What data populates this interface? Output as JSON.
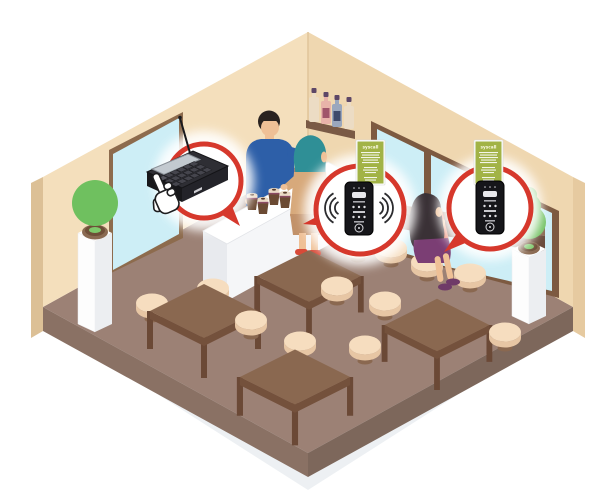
{
  "illustration": {
    "description": "Isometric cafe interior demonstrating a wireless guest paging system",
    "background": "#ffffff"
  },
  "palette": {
    "wall_left": "#f4dfbc",
    "wall_right": "#efd7b0",
    "wall_edge": "#dcc096",
    "floor": "#9c8175",
    "floor_side_left": "#8a7164",
    "floor_side_right": "#7d675b",
    "shadow": "#edf0f3",
    "glass": "#cdeef6",
    "frame_brown": "#7d5a41",
    "wood": "#8a6850",
    "wood_dark": "#74513c",
    "stool_seat": "#f6ddbf",
    "stool_side": "#e7c6a4",
    "counter_white": "#ffffff",
    "callout_red": "#d6382c",
    "banner_green": "#a2b346",
    "device_black": "#1a1a1e",
    "plant_green": "#6fc05f",
    "skin": "#efc096",
    "barista_shirt": "#2d5fa8",
    "customer_hood": "#2f8f96",
    "customer_coat": "#d7a97b",
    "woman_top": "#ef8e76",
    "woman_skirt": "#7b3e74",
    "woman_hair": "#3a3136"
  },
  "callouts": {
    "transmitter": {
      "label": "call transmitter keypad",
      "has_antenna": true,
      "pointer": "hand-click-cursor"
    },
    "pager_ringing": {
      "label": "guest pager receiving call",
      "signal_waves": true
    },
    "pager_idle": {
      "label": "guest pager",
      "signal_waves": false
    }
  },
  "banners": {
    "logo_text": "syscall"
  },
  "people": {
    "barista": "standing behind counter in blue shirt",
    "customer_standing": "customer at counter in teal hood and tan coat",
    "customer_seated": "woman in purple skirt seated on stool at window bar"
  },
  "furniture": {
    "tables": 4,
    "stools": 12,
    "plants_on_pedestals": 2,
    "bottles_on_shelf": 4,
    "coffee_cups_on_counter": 4,
    "glass_door": 1,
    "windows": 2,
    "window_bar": 1
  }
}
